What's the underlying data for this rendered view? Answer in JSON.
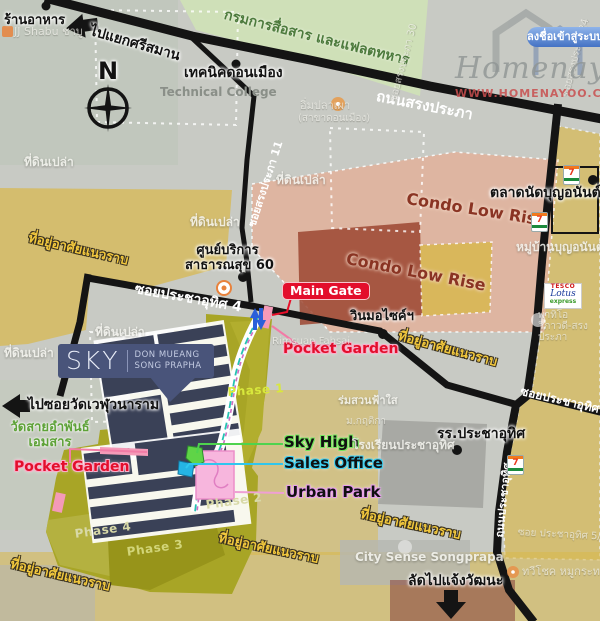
{
  "header": {
    "login_button": "ลงชื่อเข้าสู่ระบบ"
  },
  "watermark": {
    "brand": "Homenayoo",
    "url": "WWW.HOMENAYOO.COM"
  },
  "compass": {
    "north": "N"
  },
  "roads": {
    "song_prapha": "ถนนสรงประภา",
    "soi_song_prapha_11": "ซอยสรงประภา 11",
    "soi_pracha_uthit_4": "ซอยประชาอุทิศ 4",
    "soi_pracha_uthit_1": "ซอยประชาอุทิศ 1",
    "thanon_pracha_uthit": "ถนนประชาอุทิศ"
  },
  "directions": {
    "to_si_saman": "ไปแยกศรีสมาน",
    "to_wat_weluwanaram": "ไปซอยวัดเวฬุวนาราม",
    "shortcut_chaengwattana": "ลัดไปแจ้งวัฒนะ"
  },
  "places": {
    "restaurant": "ร้านอาหาร",
    "military": "กรมการสื่อสาร และแฟลตทหาร",
    "technic_don_mueang": "เทคนิคดอนเมือง",
    "technical_college": "Technical College",
    "health_center_line1": "ศูนย์บริการ",
    "health_center_line2": "สาธารณสุข 60",
    "market": "ตลาดนัดบุญอนันต์",
    "condo_low_rise": "Condo Low Rise",
    "motorcycle_taxi": "วินมอไซค์ฯ",
    "school_short": "รร.ประชาอุทิศ",
    "school_faint": "โรงเรียนประชาอุทิศ",
    "temple_line1": "วัดสายอำพันธ์",
    "temple_line2": "เอมสาร",
    "vacant_land": "ที่ดินเปล่า",
    "residential": "ที่อยู่อาศัยแนวราบ",
    "boon_anan_village": "หมู่บ้านบุญอนันต์",
    "patio": "พาทิโอ วิภาวดี-สรงประภา",
    "rimsuan_fahsai": "Rimsuan Fahsai",
    "romsuan_fahsai": "ร่มสวนฟ้าใส",
    "m_krittika": "ม.กฤติกา",
    "city_sense": "City Sense Songprapa",
    "taweechok": "ทวีโชค หมูกระทะ",
    "soi_pu_5_1": "ซอย ประชาอุทิศ 5/1",
    "im_pla_phao_line1": "อิ่มปลาเผา",
    "im_pla_phao_line2": "(สาขาดอนเมือง)",
    "jj_shabu": "JJ Shabu ชาบู",
    "soi_30": "ซอยสรงประภา 30",
    "soi_24": "ซอยสรงประภา 24"
  },
  "project": {
    "name": "SKY",
    "sub1": "DON MUEANG",
    "sub2": "SONG PRAPHA",
    "main_gate": "Main Gate",
    "pocket_garden": "Pocket Garden",
    "sky_high": "Sky High",
    "sales_office": "Sales Office",
    "urban_park": "Urban Park",
    "phase1": "Phase 1",
    "phase2": "Phase 2",
    "phase3": "Phase 3",
    "phase4": "Phase 4"
  },
  "logos": {
    "seven": "7",
    "tesco_top": "TESCO",
    "tesco_mid": "Lotus",
    "tesco_bottom": "express"
  },
  "colors": {
    "accent_red": "#e30e2c",
    "pocket_pink": "#f49ab8",
    "sky_high_green": "#5fd447",
    "sales_office_cyan": "#25b4e4",
    "urban_park_pink": "#f7b6dd",
    "project_olive": "#a8a526",
    "building_navy": "#3a4157",
    "login_blue": "#4472c4"
  }
}
